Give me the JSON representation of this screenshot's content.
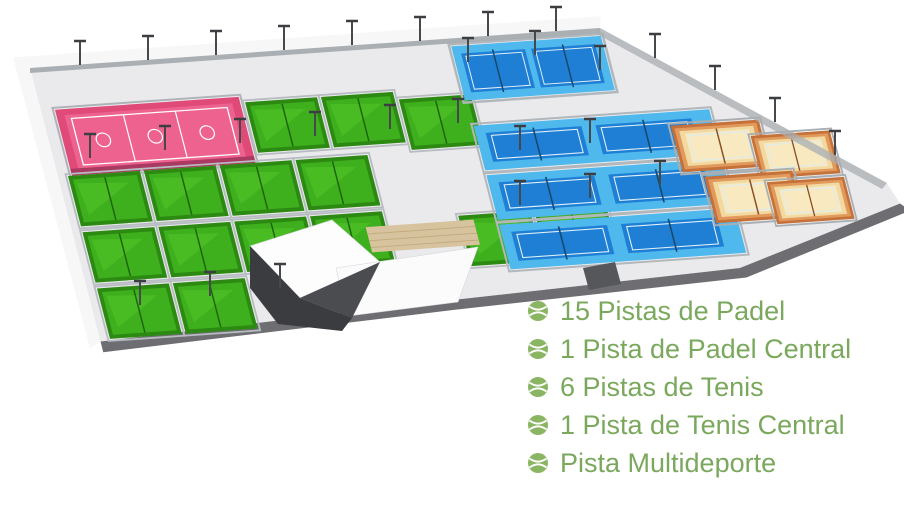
{
  "background_color": "#ffffff",
  "legend": {
    "text_color": "#7aa85c",
    "icon": "tennis-ball-icon",
    "icon_color": "#8ab562",
    "items": [
      {
        "label": "15 Pistas de Padel"
      },
      {
        "label": "1 Pista de Padel Central"
      },
      {
        "label": "6 Pistas de Tenis"
      },
      {
        "label": "1 Pista de Tenis Central"
      },
      {
        "label": "Pista Multideporte"
      }
    ]
  },
  "site_plan": {
    "platform_color": "#eaeaec",
    "court_groups": [
      {
        "name": "pistas-de-padel",
        "count": 15,
        "surface_color": "#3fb01d"
      },
      {
        "name": "pista-de-padel-central",
        "count": 1,
        "surface_color": "#1f7fd4"
      },
      {
        "name": "pistas-de-tenis",
        "count": 6,
        "surface_color": "#1f7fd4"
      },
      {
        "name": "pista-de-tenis-central",
        "count": 1,
        "surface_color": "#f2d9a2"
      },
      {
        "name": "pista-multideporte",
        "count": 1,
        "surface_color": "#ee6290"
      }
    ]
  }
}
